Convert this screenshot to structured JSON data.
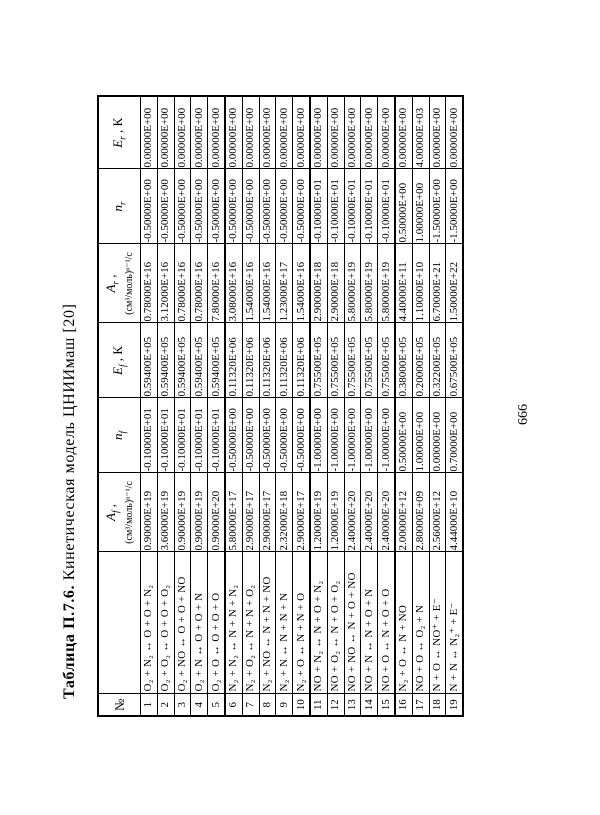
{
  "page": {
    "number": "666"
  },
  "table": {
    "title_bold": "Таблица П.7.6.",
    "title_text": " Кинетическая модель ЦНИИмаш [20]",
    "headers": {
      "no": "№",
      "reaction": "",
      "af": {
        "sym": "A",
        "sub": "f",
        "comma": " ,",
        "unit": "(см³/моль)ⁿ⁻¹/с"
      },
      "nf": {
        "sym": "n",
        "sub": "f"
      },
      "ef": {
        "sym": "E",
        "sub": "f",
        "comma": " , К"
      },
      "ar": {
        "sym": "A",
        "sub": "r",
        "comma": " ,",
        "unit": "(см³/моль)ⁿ⁻¹/с"
      },
      "nr": {
        "sym": "n",
        "sub": "r"
      },
      "er": {
        "sym": "E",
        "sub": "r",
        "comma": " , К"
      }
    },
    "rows": [
      {
        "no": "1",
        "reaction": "O₂ + N₂ ↔ O + O + N₂",
        "af": "0.90000E+19",
        "nf": "-0.10000E+01",
        "ef": "0.59400E+05",
        "ar": "0.78000E+16",
        "nr": "-0.50000E+00",
        "er": "0.00000E+00"
      },
      {
        "no": "2",
        "reaction": "O₂ + O₂ ↔ O + O + O₂",
        "af": "3.60000E+19",
        "nf": "-0.10000E+01",
        "ef": "0.59400E+05",
        "ar": "3.12000E+16",
        "nr": "-0.50000E+00",
        "er": "0.00000E+00"
      },
      {
        "no": "3",
        "reaction": "O₂ + NO ↔ O + O + NO",
        "af": "0.90000E+19",
        "nf": "-0.10000E+01",
        "ef": "0.59400E+05",
        "ar": "0.78000E+16",
        "nr": "-0.50000E+00",
        "er": "0.00000E+00"
      },
      {
        "no": "4",
        "reaction": "O₂ + N ↔ O + O + N",
        "af": "0.90000E+19",
        "nf": "-0.10000E+01",
        "ef": "0.59400E+05",
        "ar": "0.78000E+16",
        "nr": "-0.50000E+00",
        "er": "0.00000E+00"
      },
      {
        "no": "5",
        "reaction": "O₂ + O ↔ O + O + O",
        "af": "0.90000E+20",
        "nf": "-0.10000E+01",
        "ef": "0.59400E+05",
        "ar": "7.80000E+16",
        "nr": "-0.50000E+00",
        "er": "0.00000E+00"
      },
      {
        "no": "6",
        "reaction": "N₂ + N₂ ↔ N + N + N₂",
        "af": "5.80000E+17",
        "nf": "-0.50000E+00",
        "ef": "0.11320E+06",
        "ar": "3.08000E+16",
        "nr": "-0.50000E+00",
        "er": "0.00000E+00"
      },
      {
        "no": "7",
        "reaction": "N₂ + O₂ ↔ N + N + O₂",
        "af": "2.90000E+17",
        "nf": "-0.50000E+00",
        "ef": "0.11320E+06",
        "ar": "1.54000E+16",
        "nr": "-0.50000E+00",
        "er": "0.00000E+00"
      },
      {
        "no": "8",
        "reaction": "N₂ + NO ↔ N + N + NO",
        "af": "2.90000E+17",
        "nf": "-0.50000E+00",
        "ef": "0.11320E+06",
        "ar": "1.54000E+16",
        "nr": "-0.50000E+00",
        "er": "0.00000E+00"
      },
      {
        "no": "9",
        "reaction": "N₂ + N ↔ N + N + N",
        "af": "2.32000E+18",
        "nf": "-0.50000E+00",
        "ef": "0.11320E+06",
        "ar": "1.23000E+17",
        "nr": "-0.50000E+00",
        "er": "0.00000E+00"
      },
      {
        "no": "10",
        "reaction": "N₂ + O ↔ N + N + O",
        "af": "2.90000E+17",
        "nf": "-0.50000E+00",
        "ef": "0.11320E+06",
        "ar": "1.54000E+16",
        "nr": "-0.50000E+00",
        "er": "0.00000E+00"
      },
      {
        "no": "11",
        "reaction": "NO + N₂ ↔ N + O + N₂",
        "af": "1.20000E+19",
        "nf": "-1.00000E+00",
        "ef": "0.75500E+05",
        "ar": "2.90000E+18",
        "nr": "-0.10000E+01",
        "er": "0.00000E+00"
      },
      {
        "no": "12",
        "reaction": "NO + O₂ ↔ N + O + O₂",
        "af": "1.20000E+19",
        "nf": "-1.00000E+00",
        "ef": "0.75500E+05",
        "ar": "2.90000E+18",
        "nr": "-0.10000E+01",
        "er": "0.00000E+00"
      },
      {
        "no": "13",
        "reaction": "NO + NO ↔ N + O + NO",
        "af": "2.40000E+20",
        "nf": "-1.00000E+00",
        "ef": "0.75500E+05",
        "ar": "5.80000E+19",
        "nr": "-0.10000E+01",
        "er": "0.00000E+00"
      },
      {
        "no": "14",
        "reaction": "NO + N ↔ N + O + N",
        "af": "2.40000E+20",
        "nf": "-1.00000E+00",
        "ef": "0.75500E+05",
        "ar": "5.80000E+19",
        "nr": "-0.10000E+01",
        "er": "0.00000E+00"
      },
      {
        "no": "15",
        "reaction": "NO + O ↔ N + O + O",
        "af": "2.40000E+20",
        "nf": "-1.00000E+00",
        "ef": "0.75500E+05",
        "ar": "5.80000E+19",
        "nr": "-0.10000E+01",
        "er": "0.00000E+00"
      },
      {
        "no": "16",
        "reaction": "N₂ + O ↔ N + NO",
        "af": "2.00000E+12",
        "nf": "0.50000E+00",
        "ef": "0.38000E+05",
        "ar": "4.40000E+11",
        "nr": "0.50000E+00",
        "er": "0.00000E+00"
      },
      {
        "no": "17",
        "reaction": "NO + O ↔ O₂ + N",
        "af": "2.80000E+09",
        "nf": "1.00000E+00",
        "ef": "0.20000E+05",
        "ar": "1.10000E+10",
        "nr": "1.00000E+00",
        "er": "4.00000E+03"
      },
      {
        "no": "18",
        "reaction": "N + O ↔ NO⁺ + E⁻",
        "af": "2.56000E+12",
        "nf": "0.00000E+00",
        "ef": "0.32200E+05",
        "ar": "6.70000E+21",
        "nr": "-1.50000E+00",
        "er": "0.00000E+00"
      },
      {
        "no": "19",
        "reaction": "N + N ↔ N₂⁺ + E⁻",
        "af": "4.44000E+10",
        "nf": "0.70000E+00",
        "ef": "0.67500E+05",
        "ar": "1.50000E+22",
        "nr": "-1.50000E+00",
        "er": "0.00000E+00"
      }
    ]
  }
}
